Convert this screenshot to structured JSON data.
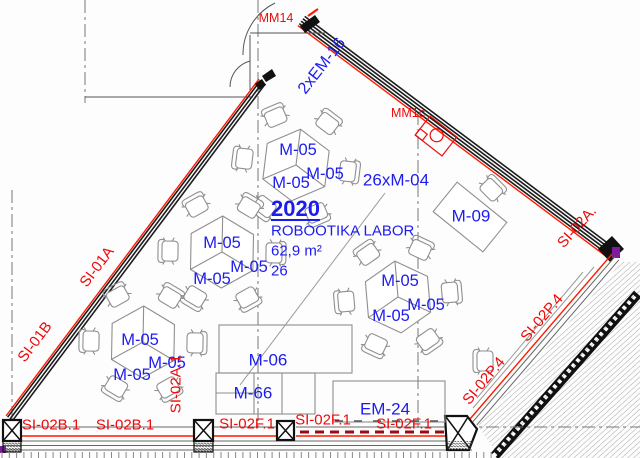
{
  "colors": {
    "label_blue": "#1c1cf0",
    "label_red": "#ee0a0a",
    "wall_dark": "#1c1c1c",
    "wall_red_line": "#ff1a00",
    "dashed_red": "#9e0b0f",
    "furniture_gray": "#8f8f8f",
    "grid_gray": "#777777",
    "accent_purple": "#7d1a9e"
  },
  "room": {
    "number": "2020",
    "name": "ROBOOTIKA LABOR",
    "area": "62,9 m²",
    "capacity": "26"
  },
  "furniture_labels": {
    "table": "M-05",
    "chairs_note": "26xM-04",
    "desk": "M-09",
    "cabinet_top": "M-06",
    "cabinet_bottom": "M-66",
    "equipment_bottom": "EM-24",
    "equipment_wall": "MM1c",
    "door": "MM14",
    "door_wall": "2xEM-16"
  },
  "wall_labels": {
    "left_upper": "SI-01A",
    "left_lower": "SI-01B",
    "right_corner": "SI-02A.",
    "right_diagonal": "SI-02P.4",
    "bottom_left_b": "SI-02B.1",
    "bottom_f": "SI-02F.1",
    "interior_vertical": "SI-02A.1"
  }
}
